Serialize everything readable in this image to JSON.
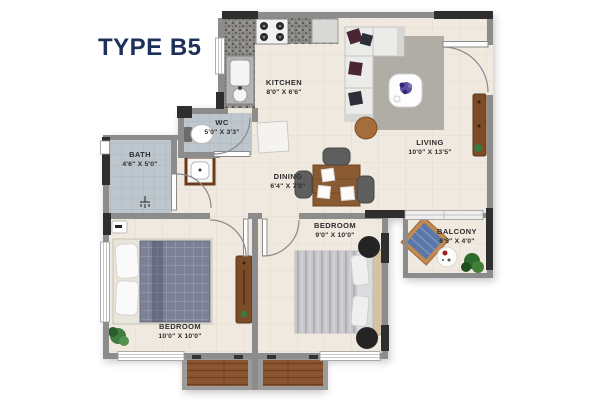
{
  "title": "TYPE B5",
  "colors": {
    "title_navy": "#1c3059",
    "wall_gray": "#8c8c8c",
    "wall_dark": "#2e2e2e",
    "floor_cream": "#efe9df",
    "bath_tile_blue": "#bdc6cc",
    "wood_brown": "#8a5a33",
    "balcony_chair_blue": "#5b77a9",
    "bed_blanket_slate": "#7b8094"
  },
  "rooms": {
    "kitchen": {
      "label": "KITCHEN",
      "dims": "8'0\" X 6'6\""
    },
    "wc": {
      "label": "WC",
      "dims": "5'0\" X 3'3\""
    },
    "bath": {
      "label": "BATH",
      "dims": "4'6\" X 5'0\""
    },
    "dining": {
      "label": "DINING",
      "dims": "6'4\" X 7'0\""
    },
    "living": {
      "label": "LIVING",
      "dims": "10'0\" X 13'5\""
    },
    "bedroom_right": {
      "label": "BEDROOM",
      "dims": "9'0\" X 10'0\""
    },
    "bedroom_left": {
      "label": "BEDROOM",
      "dims": "10'0\" X 10'0\""
    },
    "balcony": {
      "label": "BALCONY",
      "dims": "6'5\" X 4'0\""
    }
  }
}
